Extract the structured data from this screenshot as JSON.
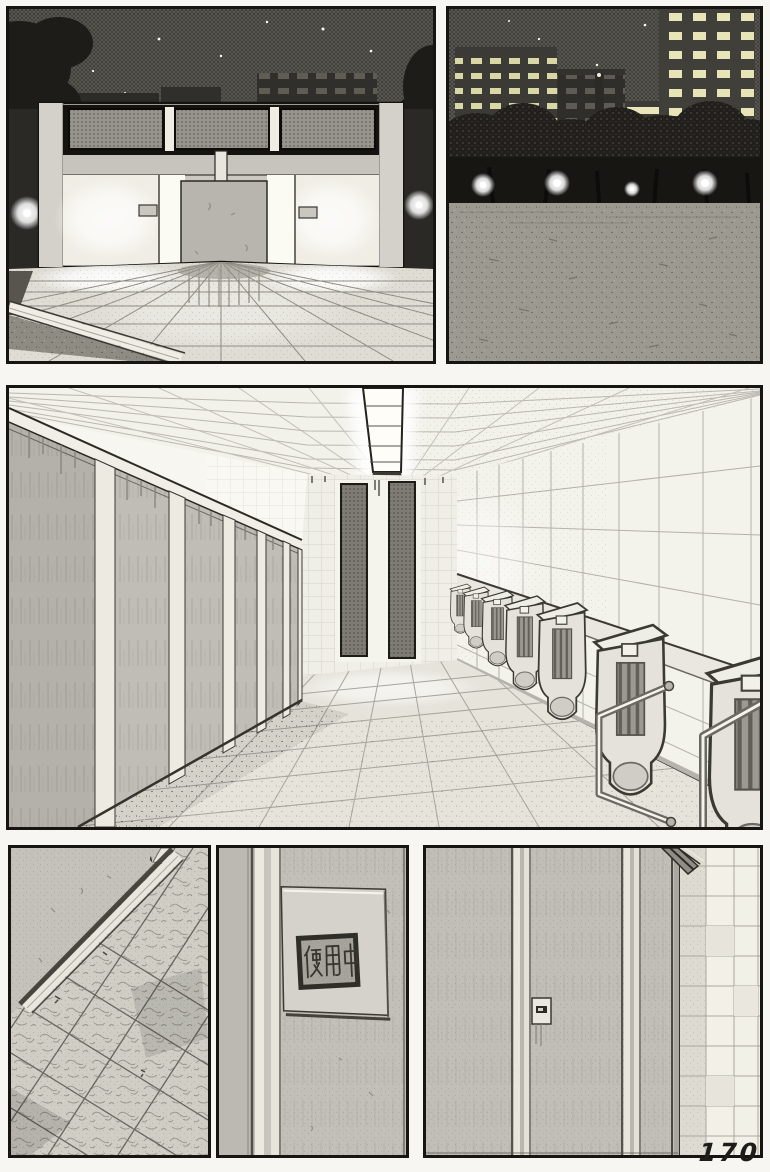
{
  "page": {
    "number": "170"
  },
  "colors": {
    "paper": "#f7f6f2",
    "ink": "#161512",
    "night_sky_halftone": "#56544f",
    "partition_gray": "#bfbdb5",
    "lit_white": "#fbfaf3",
    "window_light": "#e6e3b6"
  },
  "stall_sign": {
    "text": "使用中"
  },
  "panels": [
    {
      "id": "exterior-restroom-night",
      "alt": "Public restroom building at night: dark starry sky, trees, lit city building behind, two glowing entrances flanking a privacy screen, tiled plaza in front"
    },
    {
      "id": "park-night",
      "alt": "Night park: office buildings with lit windows, row of dark trees with round lamps, wide empty gravel field"
    },
    {
      "id": "restroom-interior",
      "alt": "Restroom interior: row of toilet stall partitions on the left, grid ceiling with long light fixture, tiled right wall with a ledge, row of urinals and grab bars, tiled floor"
    },
    {
      "id": "floor-closeup",
      "alt": "Close-up of mottled floor tiles meeting the baseboard of a stall partition"
    },
    {
      "id": "door-occupied-sign",
      "alt": "Stall door close-up with a recessed indicator plate reading occupied"
    },
    {
      "id": "door-lock-closeup",
      "alt": "Stall door close-up with small latch plate, door frame strips and tiled wall on the right"
    }
  ]
}
